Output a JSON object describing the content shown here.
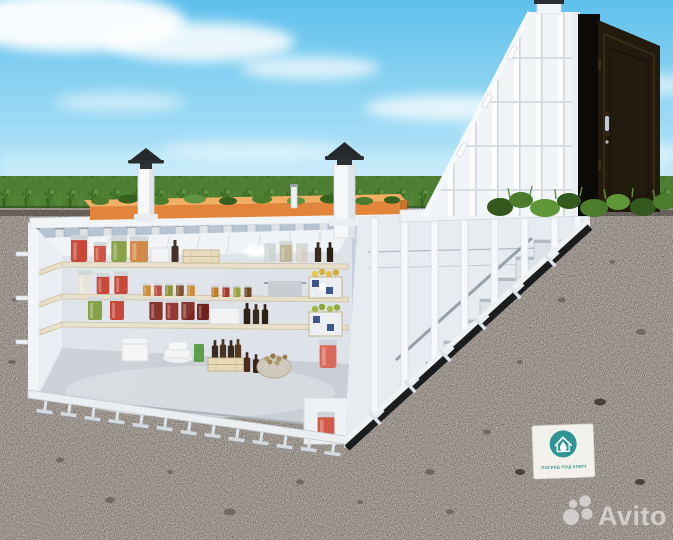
{
  "image": {
    "alt": "3D cutaway render of a turnkey plastic underground cellar buried in soil: interior with shelves of preserved jars, crates and supplies, ribbed ceiling with two ventilation pipes, orange insulation layer under a garden bed, and an inclined entrance block with an open metal door and staircase leading down"
  },
  "branding": {
    "avito_watermark": {
      "text": "Avito",
      "icon": "avito-dots-logo",
      "color": "#ffffff"
    },
    "vendor_badge": {
      "icon": "house-droplet-logo",
      "caption": "ПОГРЕБ ПОД КЛЮЧ",
      "accent_color": "#2f9494",
      "background": "#f3f1ec"
    }
  },
  "cellar_contents": [
    "jars of preserved tomatoes",
    "jars of pickled cucumbers",
    "jar of sauerkraut",
    "spice jars",
    "dark wine and oil bottles",
    "cooking pot",
    "wooden crates with apples and pears",
    "crate of bottles",
    "sack of potatoes",
    "white storage buckets",
    "green canister"
  ],
  "colors": {
    "sky_top": "#5fc0ec",
    "sky_bottom": "#cdeffb",
    "cloud": "#ffffff",
    "grass": "#4d7f33",
    "grass_dark": "#2f4a1d",
    "grass_light": "#69a348",
    "soil": "#57504a",
    "soil_speckle_dark": "#2e2a25",
    "soil_speckle_light": "#837b72",
    "shell_white": "#f2f5f8",
    "shell_shade": "#d9e0e7",
    "rib_stub": "#b6c3d1",
    "interior_wall": "#dde3e9",
    "interior_left_wall": "#e9eef3",
    "ceiling": "#f0f4f7",
    "floor": "#c9cfd5",
    "shelf_wood": "#e7dfc9",
    "insulation_top": "#f2ae63",
    "insulation_front": "#e2853a",
    "vent_pipe": "#f6f8fa",
    "vent_cap": "#26292b",
    "door_panel": "#231a0e",
    "door_opening": "#0c0a07",
    "stair_tread": "#dde2e7",
    "stair_edge": "#1b1c1d"
  }
}
